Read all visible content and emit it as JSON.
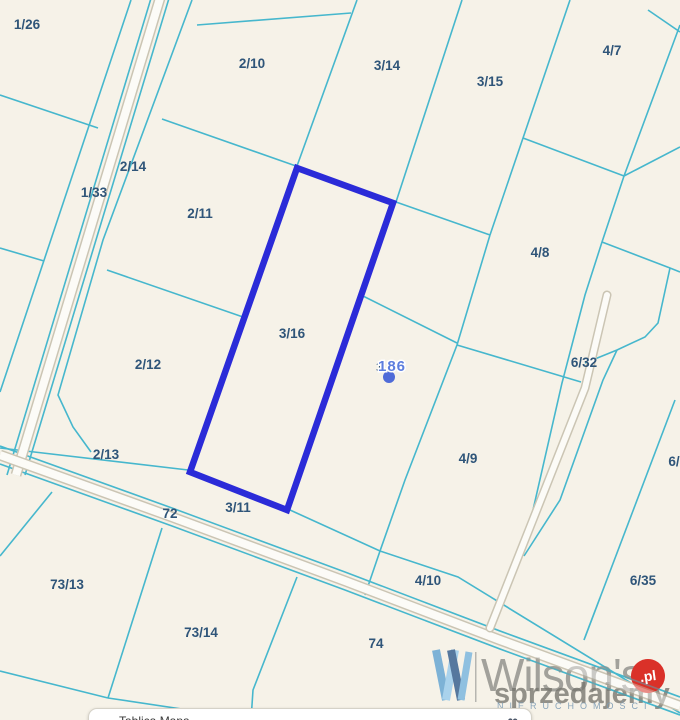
{
  "map": {
    "background_color": "#f6f2e8",
    "boundary_line_color": "#46b7cd",
    "parcel_label_color": "#2f5579",
    "highlight_color": "#2b2bd8",
    "highlighted_parcel": "3/16",
    "labels": [
      {
        "label": "1/26",
        "x": 27,
        "y": 29
      },
      {
        "label": "2/10",
        "x": 252,
        "y": 68
      },
      {
        "label": "3/14",
        "x": 387,
        "y": 70
      },
      {
        "label": "3/15",
        "x": 490,
        "y": 86
      },
      {
        "label": "4/7",
        "x": 612,
        "y": 55
      },
      {
        "label": "2/14",
        "x": 133,
        "y": 171
      },
      {
        "label": "1/33",
        "x": 94,
        "y": 197
      },
      {
        "label": "2/11",
        "x": 200,
        "y": 218
      },
      {
        "label": "4/8",
        "x": 540,
        "y": 257
      },
      {
        "label": "3/16",
        "x": 292,
        "y": 338
      },
      {
        "label": "6/32",
        "x": 584,
        "y": 367
      },
      {
        "label": "2/12",
        "x": 148,
        "y": 369
      },
      {
        "label": "2/13",
        "x": 106,
        "y": 459
      },
      {
        "label": "4/9",
        "x": 468,
        "y": 463
      },
      {
        "label": "6/",
        "x": 674,
        "y": 466
      },
      {
        "label": "3/11",
        "x": 238,
        "y": 512
      },
      {
        "label": "72",
        "x": 170,
        "y": 518
      },
      {
        "label": "73/13",
        "x": 67,
        "y": 589
      },
      {
        "label": "4/10",
        "x": 428,
        "y": 585
      },
      {
        "label": "6/35",
        "x": 643,
        "y": 585
      },
      {
        "label": "73/14",
        "x": 201,
        "y": 637
      },
      {
        "label": "74",
        "x": 376,
        "y": 648
      }
    ],
    "marker": {
      "label": "186",
      "underlay": "3",
      "dot_color": "#4f6bd8",
      "label_color": "#5d7ede"
    }
  },
  "watermark": {
    "brand": "Wilson's",
    "subtitle": "NIERUCHOMOŚCI",
    "overlay_text": "sprzedajemy",
    "overlay_badge": ".pl",
    "badge_color": "#da3129"
  },
  "bottom_bar": {
    "partial_text": "Tablica Mapa",
    "icon": "∞"
  }
}
